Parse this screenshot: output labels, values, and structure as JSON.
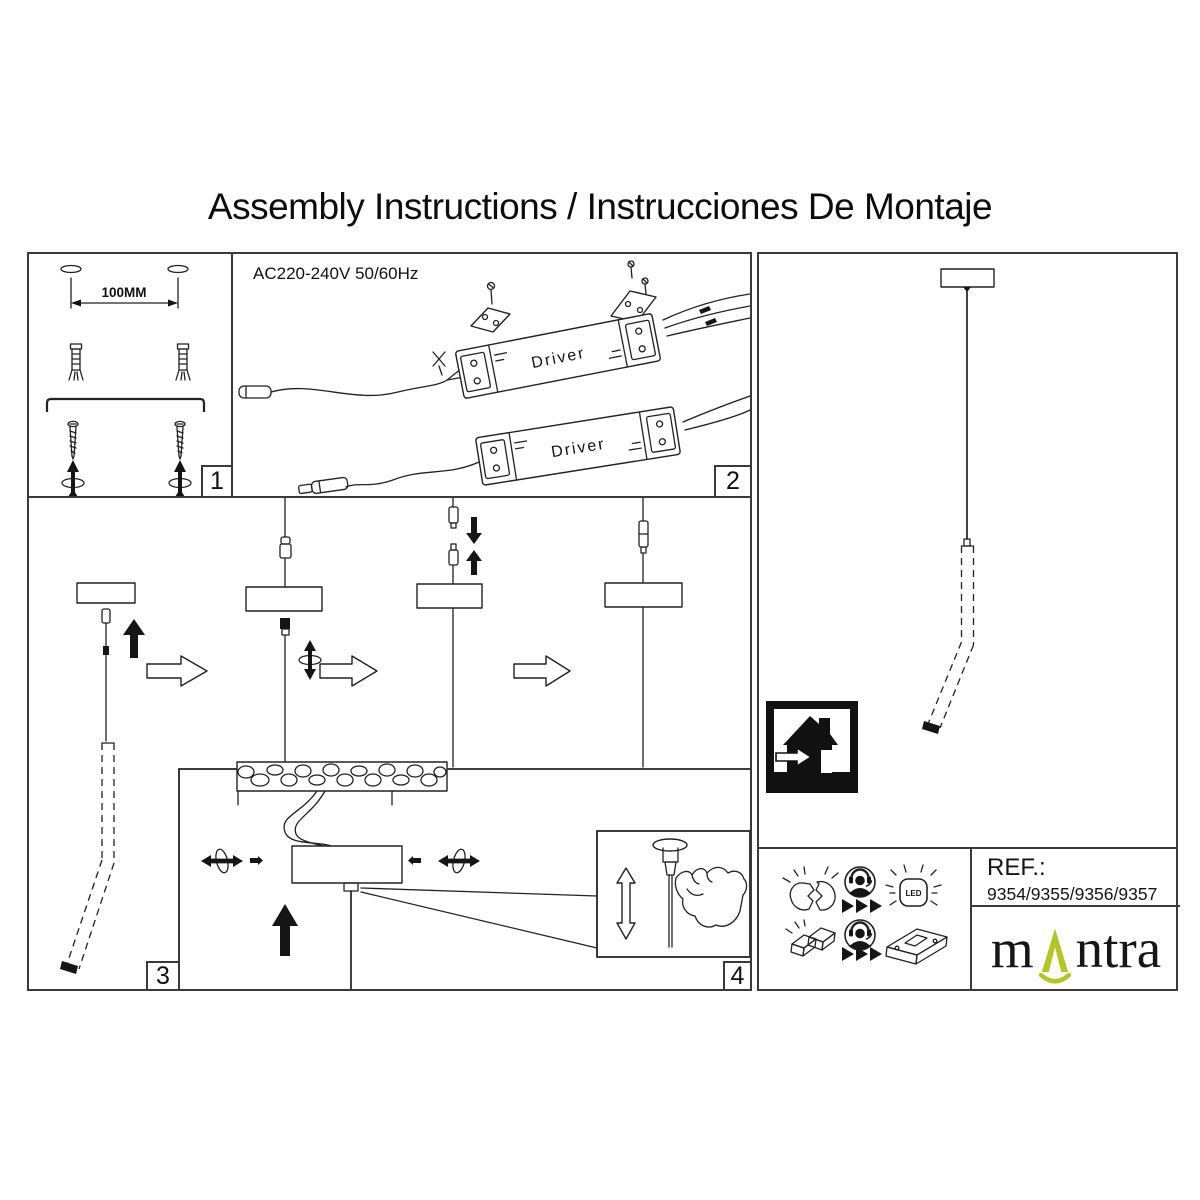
{
  "title": "Assembly Instructions / Instrucciones De Montaje",
  "colors": {
    "line": "#222222",
    "border": "#3a3a3a",
    "accent_green": "#b3c625"
  },
  "panel1": {
    "number": "1",
    "dimension": "100MM",
    "icons": [
      "keyhole-slot-icon",
      "dimension-arrow-icon",
      "wall-plug-icon",
      "mounting-bracket-icon",
      "screw-icon",
      "screw-in-rotation-icon"
    ]
  },
  "panel2": {
    "number": "2",
    "power": "AC220-240V 50/60Hz",
    "driver": "Driver",
    "icons": [
      "driver-unit-icon",
      "mounting-plate-icon",
      "screw-icon",
      "mains-wire-icon",
      "connector-icon"
    ]
  },
  "panel3": {
    "number": "3",
    "icons": [
      "push-up-arrow-icon",
      "step-arrow-icon",
      "screw-rotation-icon",
      "ceiling-section",
      "canopy-icon",
      "pendant-tube-icon"
    ]
  },
  "panel4": {
    "number": "4",
    "icons": [
      "height-adjust-arrow-icon",
      "hand-icon",
      "cord-grip-icon"
    ]
  },
  "pendant_panel": {
    "icons": [
      "canopy-icon",
      "pendant-cord",
      "pendant-tube-icon",
      "indoor-use-only-icon"
    ]
  },
  "footer": {
    "ref_label": "REF.:",
    "ref_value": "9354/9355/9356/9357",
    "led": "LED",
    "brand": {
      "m": "m",
      "ntra": "ntra"
    },
    "icons": [
      "broken-led-icon",
      "service-person-icon",
      "forward-triangles-icon",
      "led-lamp-icon",
      "broken-driver-icon",
      "driver-box-icon"
    ]
  }
}
